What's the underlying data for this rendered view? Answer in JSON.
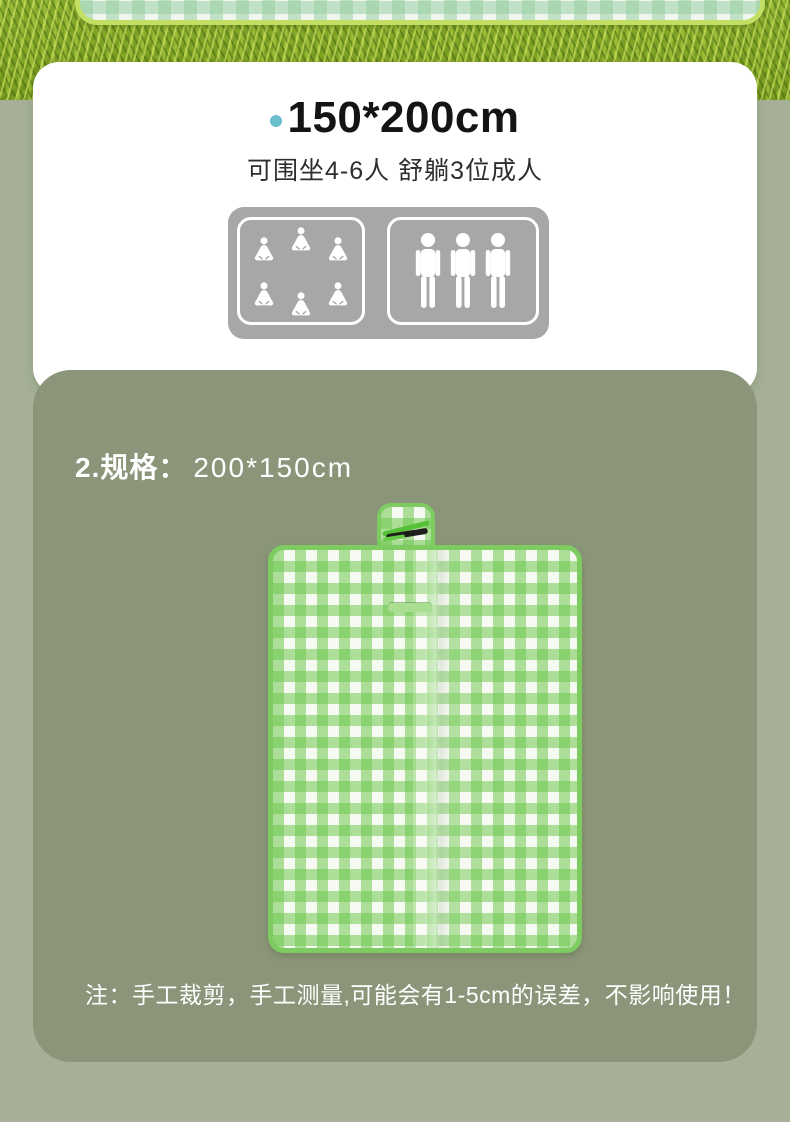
{
  "colors": {
    "page_bg": "#a6b099",
    "size_card_bg": "#8b9579",
    "panel_gray": "#a7a7a7",
    "bullet_dot": "#6bbfcc",
    "gingham_green": "#86d268",
    "mat_border_green": "#7ecb62",
    "top_mat_border": "#c3df63"
  },
  "spec_card": {
    "title": "150*200cm",
    "subtitle": "可围坐4-6人 舒躺3位成人",
    "capacity_panel": {
      "seated_count": 6,
      "standing_count": 3
    }
  },
  "size_card": {
    "heading_label": "2.规格：",
    "heading_value": "200*150cm",
    "note": "注：手工裁剪，手工测量,可能会有1-5cm的误差，不影响使用！"
  }
}
